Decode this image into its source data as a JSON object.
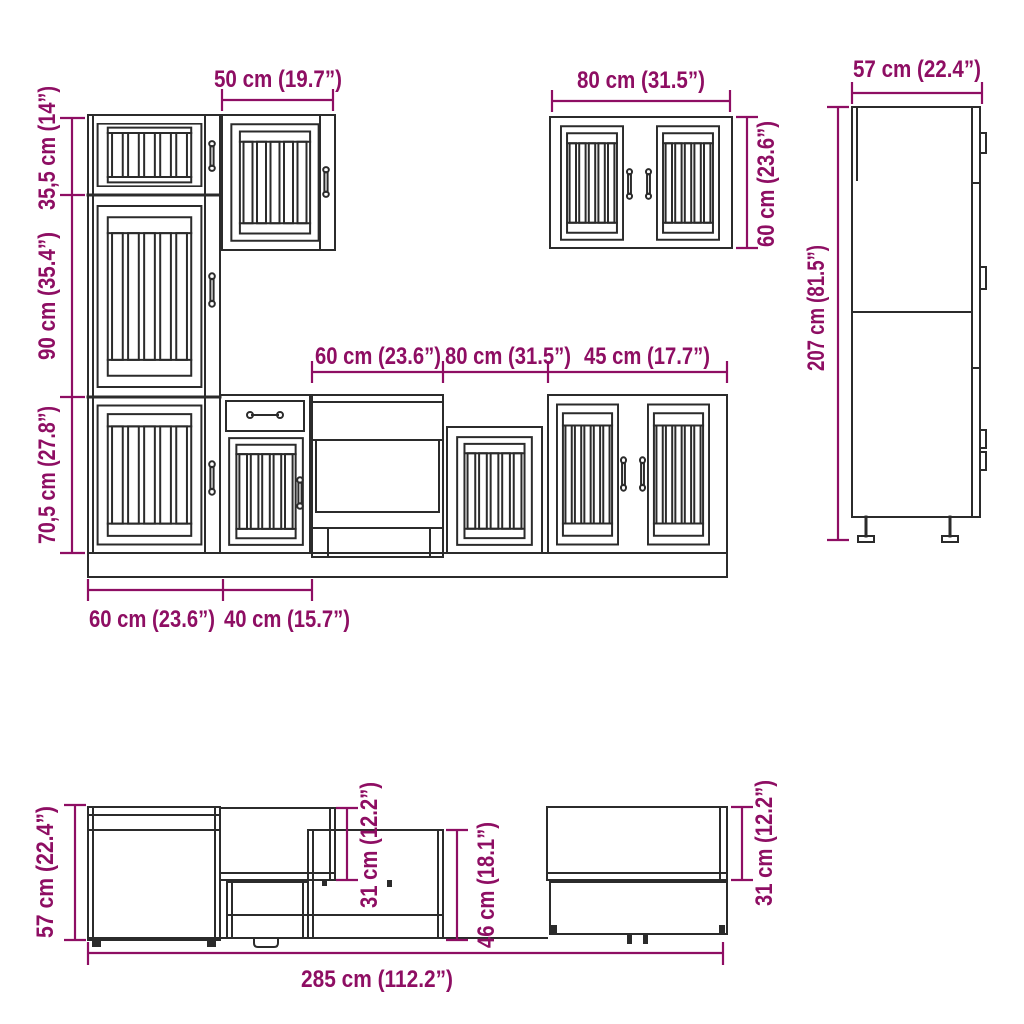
{
  "diagram": {
    "title": "7-piece kitchen cabinet set dimension diagram",
    "colors": {
      "dimension_accent": "#8E0E63",
      "line_color": "#2B2B2B",
      "background": "#FFFFFF"
    },
    "front_view": {
      "dims": {
        "wall_cabinet_width_50": "50 cm (19.7”)",
        "wall_cabinet_width_80": "80 cm (31.5”)",
        "tall_cabinet_width_57": "57 cm (22.4”)",
        "tall_cabinet_height_207": "207 cm (81.5”)",
        "upper_section_height_355": "35,5 cm (14”)",
        "middle_section_height_90": "90 cm (35.4”)",
        "lower_section_height_705": "70,5 cm (27.8”)",
        "open_unit_width_60": "60 cm (23.6”)",
        "sink_unit_width_80": "80 cm (31.5”)",
        "double_door_unit_width_45": "45 cm (17.7”)",
        "base_unit_width_60": "60 cm (23.6”)",
        "base_unit_width_40": "40 cm (15.7”)",
        "wall_cabinet_height_60": "60 cm (23.6”)"
      }
    },
    "side_view": {
      "dims": {
        "base_depth_57": "57 cm (22.4”)",
        "wall_cabinet_depth_31_left": "31 cm (12.2”)",
        "appliance_niche_height_46": "46 cm (18.1”)",
        "wall_cabinet_depth_31_right": "31 cm (12.2”)",
        "total_width_285": "285 cm (112.2”)"
      }
    }
  }
}
